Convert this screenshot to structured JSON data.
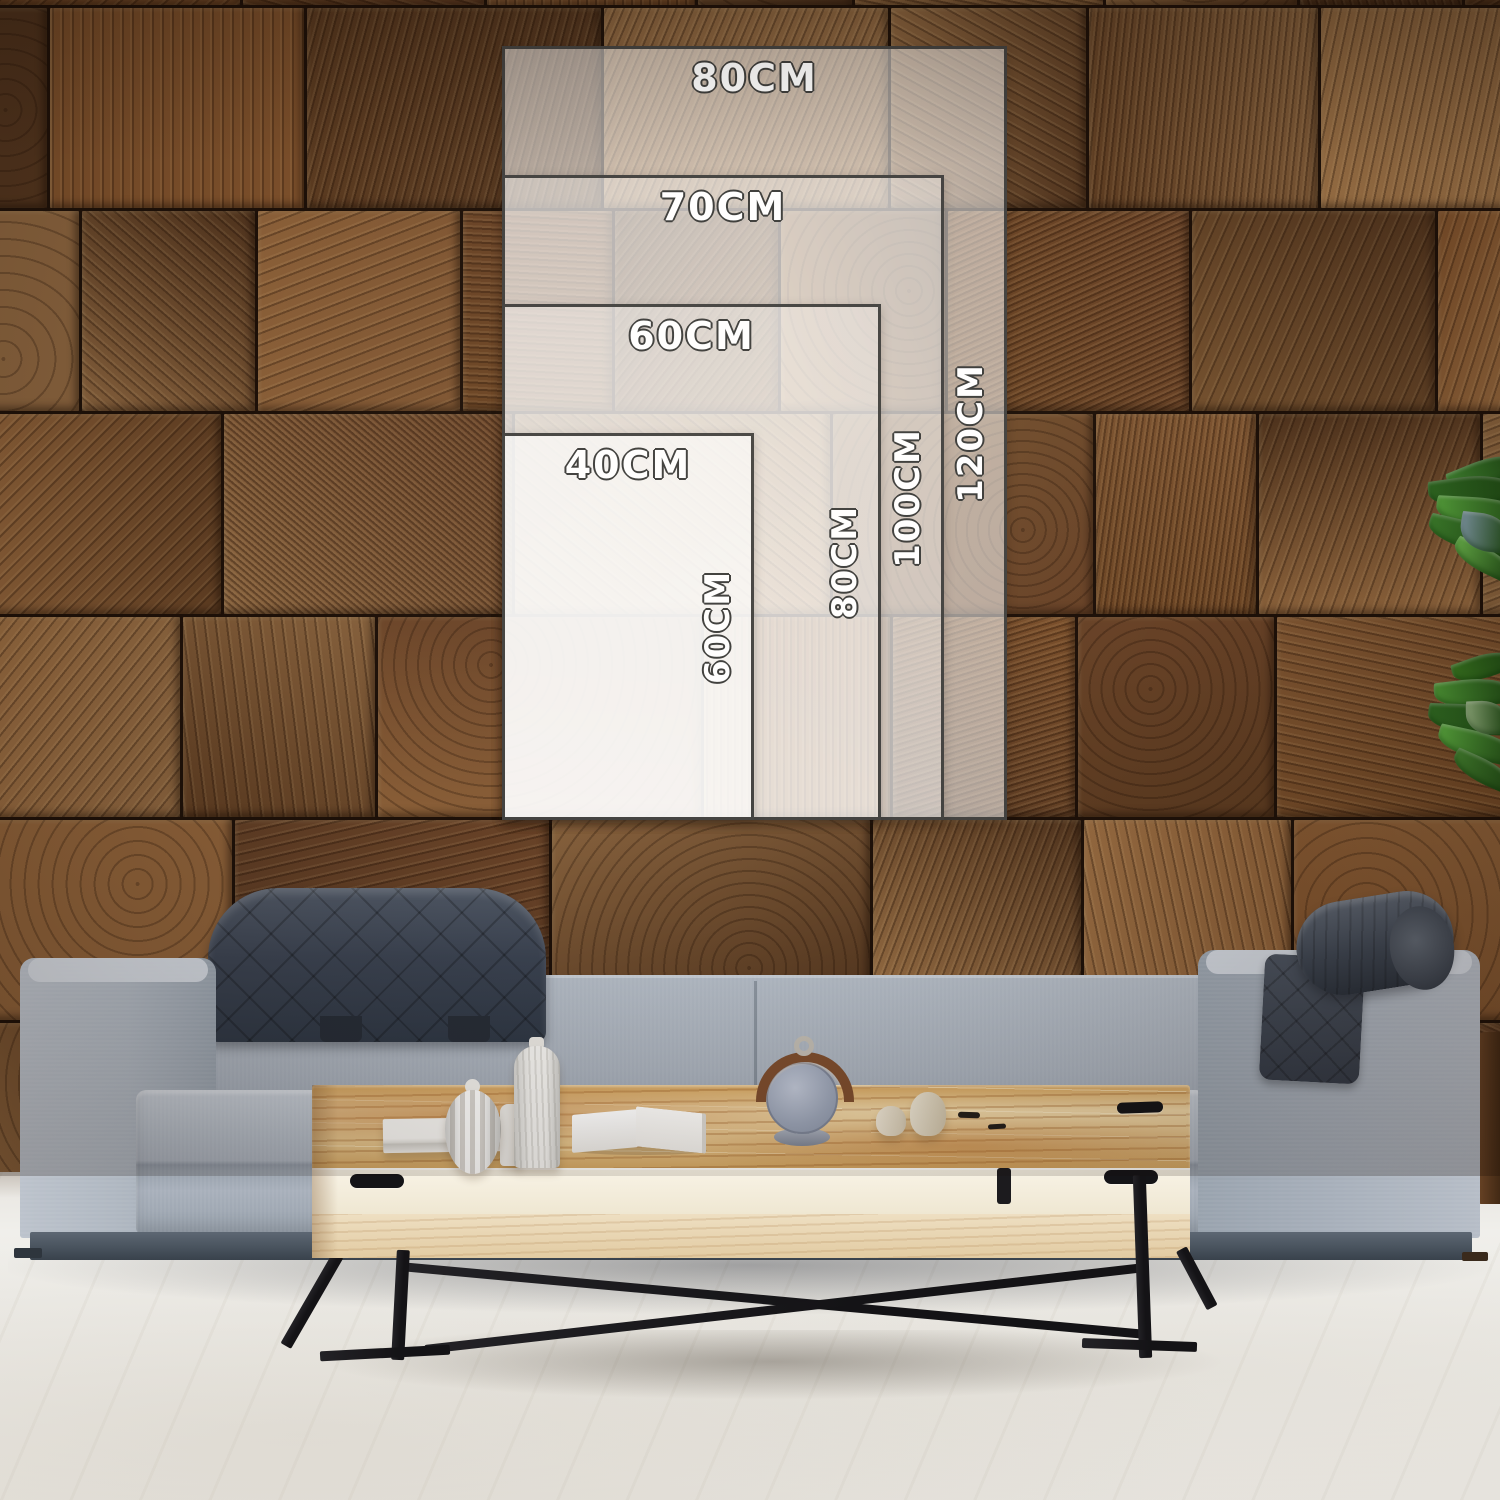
{
  "size_guide": {
    "unit": "CM",
    "sizes": [
      {
        "width_cm": 80,
        "height_cm": 120,
        "width_label": "80CM",
        "height_label": "120CM"
      },
      {
        "width_cm": 70,
        "height_cm": 100,
        "width_label": "70CM",
        "height_label": "100CM"
      },
      {
        "width_cm": 60,
        "height_cm": 80,
        "width_label": "60CM",
        "height_label": "80CM"
      },
      {
        "width_cm": 40,
        "height_cm": 60,
        "width_label": "40CM",
        "height_label": "60CM"
      }
    ]
  },
  "scene": {
    "colors": {
      "wall_seam": "#1d1008",
      "wood_dark": "#5a3a20",
      "wood_mid": "#7d5431",
      "wood_light": "#9b7146",
      "overlay_border": "#434240",
      "sofa_fabric": "#a9b1bc",
      "sofa_base": "#49535e",
      "headrest_dark": "#3a424e",
      "table_top_wood": "#e2bf85",
      "table_face": "#f2ecdc",
      "metal_black": "#17171a",
      "floor_light": "#eae8e3",
      "plant_green": "#4c9635"
    }
  }
}
